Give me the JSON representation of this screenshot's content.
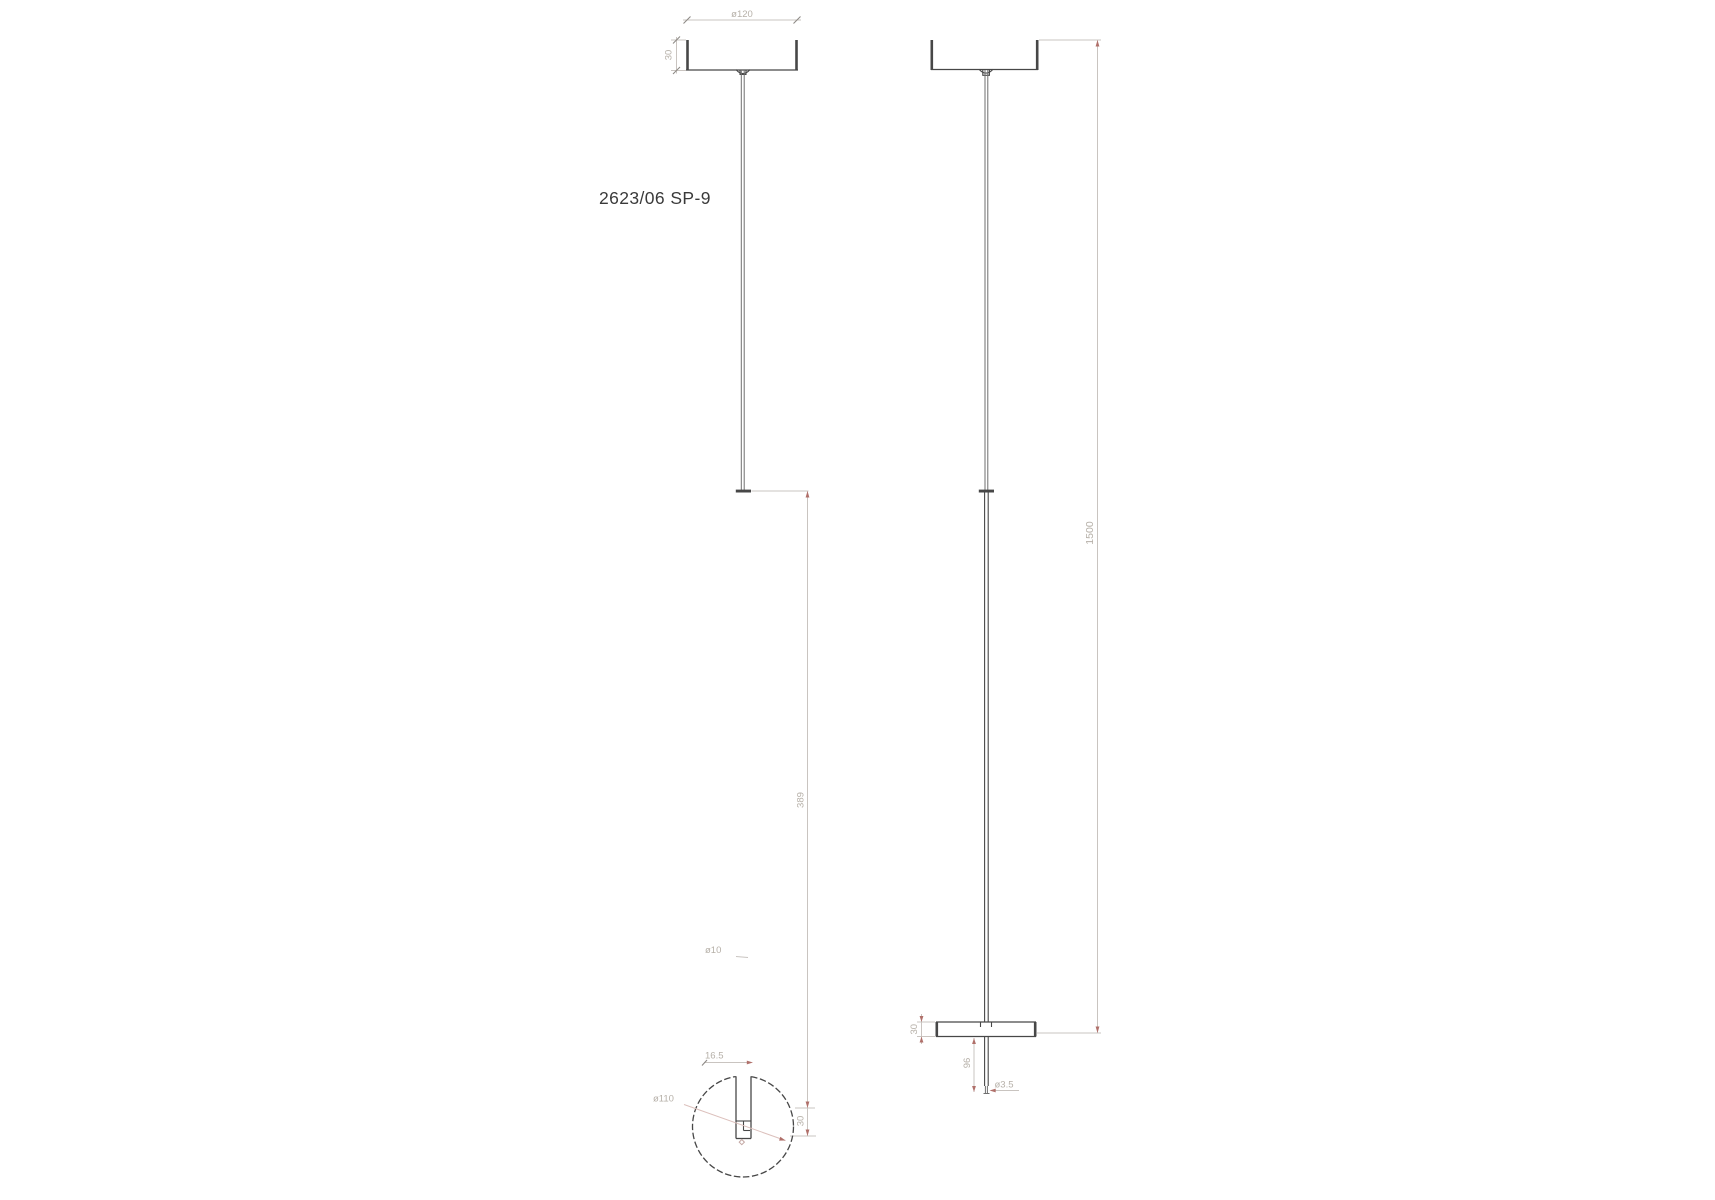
{
  "drawing": {
    "label": "2623/06 SP-9"
  },
  "front": {
    "dim_canopy_diameter": "ø120",
    "dim_canopy_height": "30",
    "dim_stem_length": "389",
    "dim_disc_thickness": "30",
    "dim_stem_diameter": "ø10"
  },
  "bottom": {
    "dim_slot_width": "16.5",
    "dim_disc_diameter": "ø110"
  },
  "side": {
    "dim_disc_thickness": "30",
    "dim_tip_length": "96",
    "dim_tip_diameter": "ø3.5",
    "dim_total_height": "1500"
  },
  "colors": {
    "line_dark": "#474747",
    "line_dim": "#c9c4c0",
    "text_dim": "#b6b0a8",
    "accent_red": "#b0706a",
    "leader_pink": "#dcc0bc",
    "label_color": "#3a3a3a",
    "page_bg": "#ffffff"
  }
}
